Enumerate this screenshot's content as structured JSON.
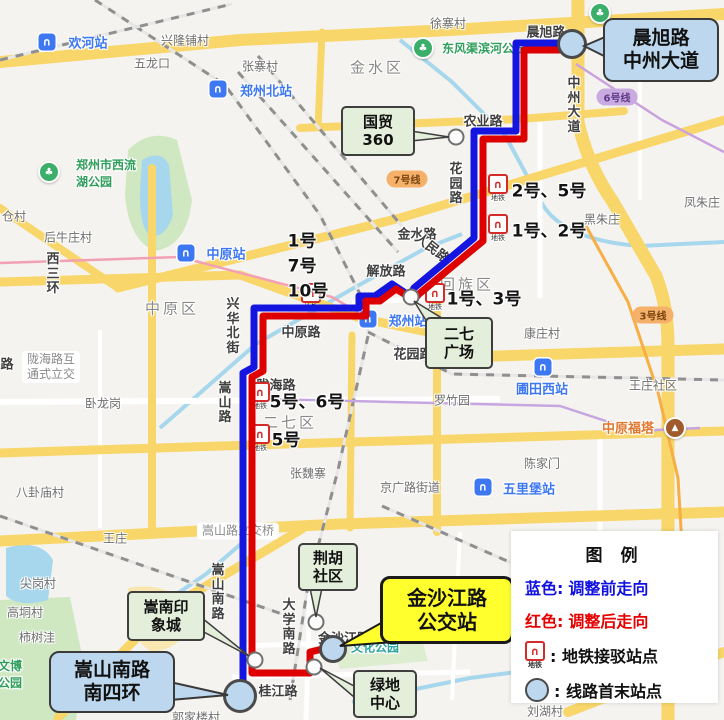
{
  "title": "郑州公交线路调整示意图",
  "colors": {
    "bg": "#F5F3EF",
    "route_blue": "#1515E0",
    "route_red": "#DE0000",
    "callout_blue": "#BDD7EE",
    "callout_green": "#E3EFDA",
    "callout_yellow": "#FFFF2E",
    "terminal_fill": "#BCD7EE",
    "stop_fill": "#FCFCFC",
    "road_yellow": "#F8D66A",
    "road_white": "#FFFFFF",
    "water": "#A6D7EC",
    "legend_blue": "#1111E0",
    "legend_red": "#E60000"
  },
  "legend": {
    "title": "图  例",
    "blue_row": {
      "prefix": "蓝色:",
      "text": "调整前走向"
    },
    "red_row": {
      "prefix": "红色:",
      "text": "调整后走向"
    },
    "metro_row": {
      "text": ": 地铁接驳站点"
    },
    "terminal_row": {
      "text": ": 线路首末站点"
    },
    "metro_icon_label": "地铁",
    "metro_icon_glyph": "∩"
  },
  "callouts": [
    {
      "id": "callout-chenxu-zhongzhou",
      "type": "blue",
      "lines": [
        "晨旭路",
        "中州大道"
      ],
      "x": 661,
      "y": 50,
      "w": 112,
      "h": 60,
      "tail": "584,46 612,34 612,60"
    },
    {
      "id": "callout-guomao-360",
      "type": "green",
      "lines": [
        "国贸",
        "360"
      ],
      "x": 378,
      "y": 131,
      "w": 70,
      "h": 46,
      "tail": "449,137 411,131 411,141"
    },
    {
      "id": "callout-erqi-guangchang",
      "type": "green",
      "lines": [
        "二七",
        "广场"
      ],
      "x": 459,
      "y": 343,
      "w": 64,
      "h": 48,
      "tail": "414,301 445,320 432,330"
    },
    {
      "id": "callout-songnan-yinxiangcheng",
      "type": "green",
      "lines": [
        "嵩南印",
        "象城"
      ],
      "x": 166,
      "y": 616,
      "w": 74,
      "h": 46,
      "tail": "249,656 202,618 202,631"
    },
    {
      "id": "callout-songshannanlu-nansihuan",
      "type": "blue",
      "lines": [
        "嵩山南路",
        "南四环"
      ],
      "x": 112,
      "y": 682,
      "w": 122,
      "h": 58,
      "tail": "228,695 170,682 170,700"
    },
    {
      "id": "callout-jinshajianglu-bus-stop",
      "type": "yellow",
      "lines": [
        "金沙江路",
        "公交站"
      ],
      "x": 447,
      "y": 610,
      "w": 128,
      "h": 62,
      "tail": "340,646 390,618 394,642"
    },
    {
      "id": "callout-jinghu-shequ",
      "type": "green",
      "lines": [
        "荆胡",
        "社区"
      ],
      "x": 328,
      "y": 567,
      "w": 56,
      "h": 44,
      "tail": "316,617 310,588 322,588"
    },
    {
      "id": "callout-lvdi-zhongxin",
      "type": "green",
      "lines": [
        "绿地",
        "中心"
      ],
      "x": 385,
      "y": 694,
      "w": 60,
      "h": 44,
      "tail": "320,668 354,686 354,697"
    }
  ],
  "routes": {
    "blue": {
      "label": "调整前走向",
      "points": "570,43 516,43 516,131 474,131 474,238 414,288 410,296 392,284 375,296 359,296 359,308 254,308 254,367 243,373 243,692",
      "w": 7
    },
    "red": {
      "label": "调整后走向",
      "points": "570,50 524,50 524,139 483,139 483,241 419,294 414,300 396,289 380,301 366,301 366,316 263,316 263,371 252,377 252,673 310,673 310,652 327,648",
      "w": 7
    }
  },
  "terminals": [
    {
      "name": "晨旭路中州大道",
      "x": 572,
      "y": 44,
      "r": 12
    },
    {
      "name": "嵩山南路南四环",
      "x": 240,
      "y": 696,
      "r": 14
    },
    {
      "name": "金沙江路公交站",
      "x": 333,
      "y": 649,
      "r": 11
    }
  ],
  "stops": [
    {
      "name": "国贸360",
      "x": 456,
      "y": 137
    },
    {
      "name": "二七广场",
      "x": 411,
      "y": 297
    },
    {
      "name": "嵩南印象城",
      "x": 255,
      "y": 660
    },
    {
      "name": "荆胡社区",
      "x": 316,
      "y": 622
    },
    {
      "name": "绿地中心",
      "x": 314,
      "y": 667
    }
  ],
  "metro_stops": [
    {
      "icon": [
        498,
        188
      ],
      "lines": [
        "2号、5号"
      ],
      "lx": 549,
      "ly": 189
    },
    {
      "icon": [
        498,
        228
      ],
      "lines": [
        "1号、2号"
      ],
      "lx": 549,
      "ly": 229
    },
    {
      "icon": [
        435,
        297
      ],
      "lines": [
        "1号、3号"
      ],
      "lx": 484,
      "ly": 297
    },
    {
      "icon": [
        311,
        297
      ],
      "lines": [
        "1号",
        "7号",
        "10号"
      ],
      "lx": 308,
      "ly": 264
    },
    {
      "icon": [
        260,
        396
      ],
      "lines": [
        "5号、6号"
      ],
      "lx": 307,
      "ly": 400
    },
    {
      "icon": [
        260,
        438
      ],
      "lines": [
        "5号"
      ],
      "lx": 286,
      "ly": 438
    }
  ],
  "station_badges": [
    {
      "text": "欢河站",
      "ix": 47,
      "iy": 42,
      "tx": 88,
      "ty": 42
    },
    {
      "text": "郑州北站",
      "ix": 218,
      "iy": 89,
      "tx": 266,
      "ty": 90
    },
    {
      "text": "中原站",
      "ix": 186,
      "iy": 253,
      "tx": 226,
      "ty": 253
    },
    {
      "text": "郑州站",
      "ix": 368,
      "iy": 319,
      "tx": 408,
      "ty": 320
    },
    {
      "text": "圃田西站",
      "ix": 543,
      "iy": 367,
      "tx": 542,
      "ty": 388
    },
    {
      "text": "五里堡站",
      "ix": 483,
      "iy": 487,
      "tx": 529,
      "ty": 488
    }
  ],
  "line_pills": [
    {
      "text": "7号线",
      "x": 407,
      "y": 179,
      "bg": "#F5B06A",
      "fg": "#7A4510"
    },
    {
      "text": "3号线",
      "x": 653,
      "y": 315,
      "bg": "#F5B06A",
      "fg": "#7A4510"
    },
    {
      "text": "6号线",
      "x": 617,
      "y": 97,
      "bg": "#C9ABE2",
      "fg": "#5E3A87"
    }
  ],
  "pins": [
    {
      "type": "park",
      "x": 423,
      "y": 48
    },
    {
      "type": "park",
      "x": 49,
      "y": 172
    },
    {
      "type": "park",
      "x": 600,
      "y": 13
    },
    {
      "type": "tower",
      "x": 675,
      "y": 428
    }
  ],
  "districts": [
    {
      "t": "金水区",
      "x": 377,
      "y": 67
    },
    {
      "t": "中原区",
      "x": 172,
      "y": 308
    },
    {
      "t": "回族区",
      "x": 467,
      "y": 284
    },
    {
      "t": "二七区",
      "x": 290,
      "y": 422
    }
  ],
  "places": [
    {
      "t": "兴隆铺村",
      "x": 185,
      "y": 40
    },
    {
      "t": "五龙口",
      "x": 152,
      "y": 63
    },
    {
      "t": "张寨村",
      "x": 260,
      "y": 66
    },
    {
      "t": "徐寨村",
      "x": 448,
      "y": 23
    },
    {
      "t": "黑朱庄",
      "x": 602,
      "y": 219
    },
    {
      "t": "凤朱庄",
      "x": 702,
      "y": 202
    },
    {
      "t": "后牛庄村",
      "x": 68,
      "y": 237
    },
    {
      "t": "仓村",
      "x": 14,
      "y": 216
    },
    {
      "t": "康庄村",
      "x": 542,
      "y": 333
    },
    {
      "t": "王庄社区",
      "x": 653,
      "y": 385
    },
    {
      "t": "罗竹园",
      "x": 452,
      "y": 400
    },
    {
      "t": "陈家门",
      "x": 542,
      "y": 463
    },
    {
      "t": "张魏寨",
      "x": 308,
      "y": 473
    },
    {
      "t": "京广路街道",
      "x": 410,
      "y": 487
    },
    {
      "t": "八卦庙村",
      "x": 40,
      "y": 492
    },
    {
      "t": "王庄",
      "x": 115,
      "y": 538
    },
    {
      "t": "尖岗村",
      "x": 38,
      "y": 583
    },
    {
      "t": "高垌村",
      "x": 25,
      "y": 612
    },
    {
      "t": "柿树洼",
      "x": 37,
      "y": 637
    },
    {
      "t": "卧龙岗",
      "x": 103,
      "y": 403
    },
    {
      "t": "刘湖村",
      "x": 545,
      "y": 711
    },
    {
      "t": "郭家楼村",
      "x": 196,
      "y": 717
    }
  ],
  "streets": [
    {
      "t": "晨旭路",
      "x": 546,
      "y": 31
    },
    {
      "t": "中州大道",
      "x": 574,
      "y": 106,
      "v": 1
    },
    {
      "t": "农业路",
      "x": 483,
      "y": 120
    },
    {
      "t": "花园路",
      "x": 456,
      "y": 185,
      "v": 1
    },
    {
      "t": "金水路",
      "x": 417,
      "y": 233
    },
    {
      "t": "人民路",
      "x": 433,
      "y": 247,
      "rot": 38
    },
    {
      "t": "解放路",
      "x": 386,
      "y": 270
    },
    {
      "t": "中原路",
      "x": 301,
      "y": 331
    },
    {
      "t": "兴华北街",
      "x": 233,
      "y": 327,
      "v": 1
    },
    {
      "t": "嵩山路",
      "x": 225,
      "y": 404,
      "v": 1
    },
    {
      "t": "陇海路",
      "x": 276,
      "y": 384
    },
    {
      "t": "嵩山南路",
      "x": 218,
      "y": 593,
      "v": 1
    },
    {
      "t": "大学南路",
      "x": 289,
      "y": 628,
      "v": 1
    },
    {
      "t": "桂江路",
      "x": 278,
      "y": 690
    },
    {
      "t": "金沙江路",
      "x": 344,
      "y": 637
    },
    {
      "t": "西三环",
      "x": 53,
      "y": 275,
      "v": 1
    },
    {
      "t": "路",
      "x": 7,
      "y": 363
    },
    {
      "t": "花园路",
      "x": 413,
      "y": 353
    }
  ],
  "parks": [
    {
      "lines": [
        "东风渠滨河公园"
      ],
      "x": 484,
      "y": 48
    },
    {
      "lines": [
        "郑州市西流",
        "湖公园"
      ],
      "x": 106,
      "y": 173
    },
    {
      "lines": [
        "文博",
        "公园"
      ],
      "x": 10,
      "y": 674
    },
    {
      "lines": [
        "文化公园"
      ],
      "x": 375,
      "y": 647,
      "teal": 1
    }
  ],
  "attractions": [
    {
      "t": "中原福塔",
      "x": 628,
      "y": 427
    }
  ],
  "road_pills": [
    {
      "lines": [
        "嵩山路立交桥"
      ],
      "x": 238,
      "y": 531
    },
    {
      "lines": [
        "陇海路互",
        "通式立交"
      ],
      "x": 51,
      "y": 367
    }
  ],
  "geo": {
    "area_fills": [
      {
        "d": "M128,150 Q150,128 177,140 L192,200 Q187,246 155,251 Q129,241 125,195 Z",
        "f": "#CFE8C2"
      },
      {
        "d": "M0,600 L70,597 L83,660 L76,720 L0,720 Z",
        "f": "#CFE8C2"
      },
      {
        "d": "M330,641 L420,633 L428,661 L340,669 Z",
        "f": "#DDEDD0"
      },
      {
        "d": "M128,588 Q170,580 192,612 Q188,648 152,652 Q124,636 128,588 Z",
        "f": "#F8E7B0"
      },
      {
        "d": "M142,160 Q161,149 169,165 L173,215 Q166,238 150,236 Q139,226 140,190 Z",
        "f": "#A6D7EC"
      },
      {
        "d": "M6,548 Q40,538 53,560 L48,600 Q20,608 6,596 Z",
        "f": "#A6D7EC"
      }
    ],
    "water_lines": [
      {
        "d": "M400,40 L452,82 L505,135 L540,200 Q560,240 640,246 L724,242",
        "w": 4
      },
      {
        "d": "M160,428 L256,344 L352,289 L424,249 L462,234",
        "w": 4
      },
      {
        "d": "M130,626 L206,574 L249,537",
        "w": 4
      },
      {
        "d": "M352,702 L470,678 L540,669",
        "w": 4
      }
    ],
    "white_roads": [
      {
        "d": "M246,372 L243,696",
        "w": 6
      },
      {
        "d": "M310,590 L306,720",
        "w": 5
      },
      {
        "d": "M238,646 L460,639",
        "w": 5
      },
      {
        "d": "M232,677 L470,672",
        "w": 5
      },
      {
        "d": "M480,132 L480,242",
        "w": 6
      },
      {
        "d": "M420,298 L476,246",
        "w": 6
      },
      {
        "d": "M352,303 L432,298",
        "w": 5
      },
      {
        "d": "M254,311 L356,306",
        "w": 5
      },
      {
        "d": "M0,402 L500,399",
        "w": 6
      },
      {
        "d": "M600,430 L600,700",
        "w": 5
      },
      {
        "d": "M540,122 L540,298",
        "w": 5
      },
      {
        "d": "M100,330 L100,528",
        "w": 4
      },
      {
        "d": "M460,532 L452,700",
        "w": 4
      },
      {
        "d": "M516,45 L516,130",
        "w": 5
      },
      {
        "d": "M480,44 L572,42",
        "w": 5
      },
      {
        "d": "M640,58 L640,200",
        "w": 4
      }
    ],
    "yellow_roads": [
      {
        "d": "M0,62 L240,40 L450,30 L724,14",
        "w": 12
      },
      {
        "d": "M578,0 L578,122 Q588,166 613,202 L656,276 Q668,306 668,346 L668,720",
        "w": 13
      },
      {
        "d": "M300,128 L520,119 L624,111",
        "w": 8
      },
      {
        "d": "M118,288 L400,218 L724,120",
        "w": 9
      },
      {
        "d": "M0,282 L240,275 L360,318 L437,334",
        "w": 9
      },
      {
        "d": "M430,358 L724,349",
        "w": 11
      },
      {
        "d": "M0,453 L220,446 L724,431",
        "w": 9
      },
      {
        "d": "M0,541 L340,524 L724,512",
        "w": 11
      },
      {
        "d": "M437,300 L437,532",
        "w": 8
      },
      {
        "d": "M152,168 L152,526",
        "w": 8
      },
      {
        "d": "M58,718 L162,612 L302,529",
        "w": 9
      },
      {
        "d": "M568,712 L724,652",
        "w": 10
      },
      {
        "d": "M0,208 L118,288",
        "w": 8
      },
      {
        "d": "M322,32 L318,128",
        "w": 7
      },
      {
        "d": "M352,335 L350,528",
        "w": 7
      }
    ],
    "railways": [
      {
        "d": "M95,0 L225,85 L320,215 L362,298 L368,332"
      },
      {
        "d": "M238,72 L398,252"
      },
      {
        "d": "M258,56 L412,238"
      },
      {
        "d": "M368,332 L452,374 L724,380"
      },
      {
        "d": "M368,336 L338,470 L308,585 L290,700"
      },
      {
        "d": "M0,516 L282,614"
      },
      {
        "d": "M382,506 L564,586"
      },
      {
        "d": "M0,60 L232,4"
      }
    ],
    "metro_lines": [
      {
        "d": "M0,263 L180,257 L332,297 L366,317",
        "c": "#F2A0B4",
        "w": 2.5
      },
      {
        "d": "M266,399 L560,406 L636,431 L700,428",
        "c": "#C5A6E0",
        "w": 2.5
      },
      {
        "d": "M576,64 L662,120 L724,152",
        "c": "#C9A2DE",
        "w": 2.5
      },
      {
        "d": "M586,226 L628,302 L658,392 L678,478 L682,545",
        "c": "#F6AE45",
        "w": 3
      }
    ]
  }
}
